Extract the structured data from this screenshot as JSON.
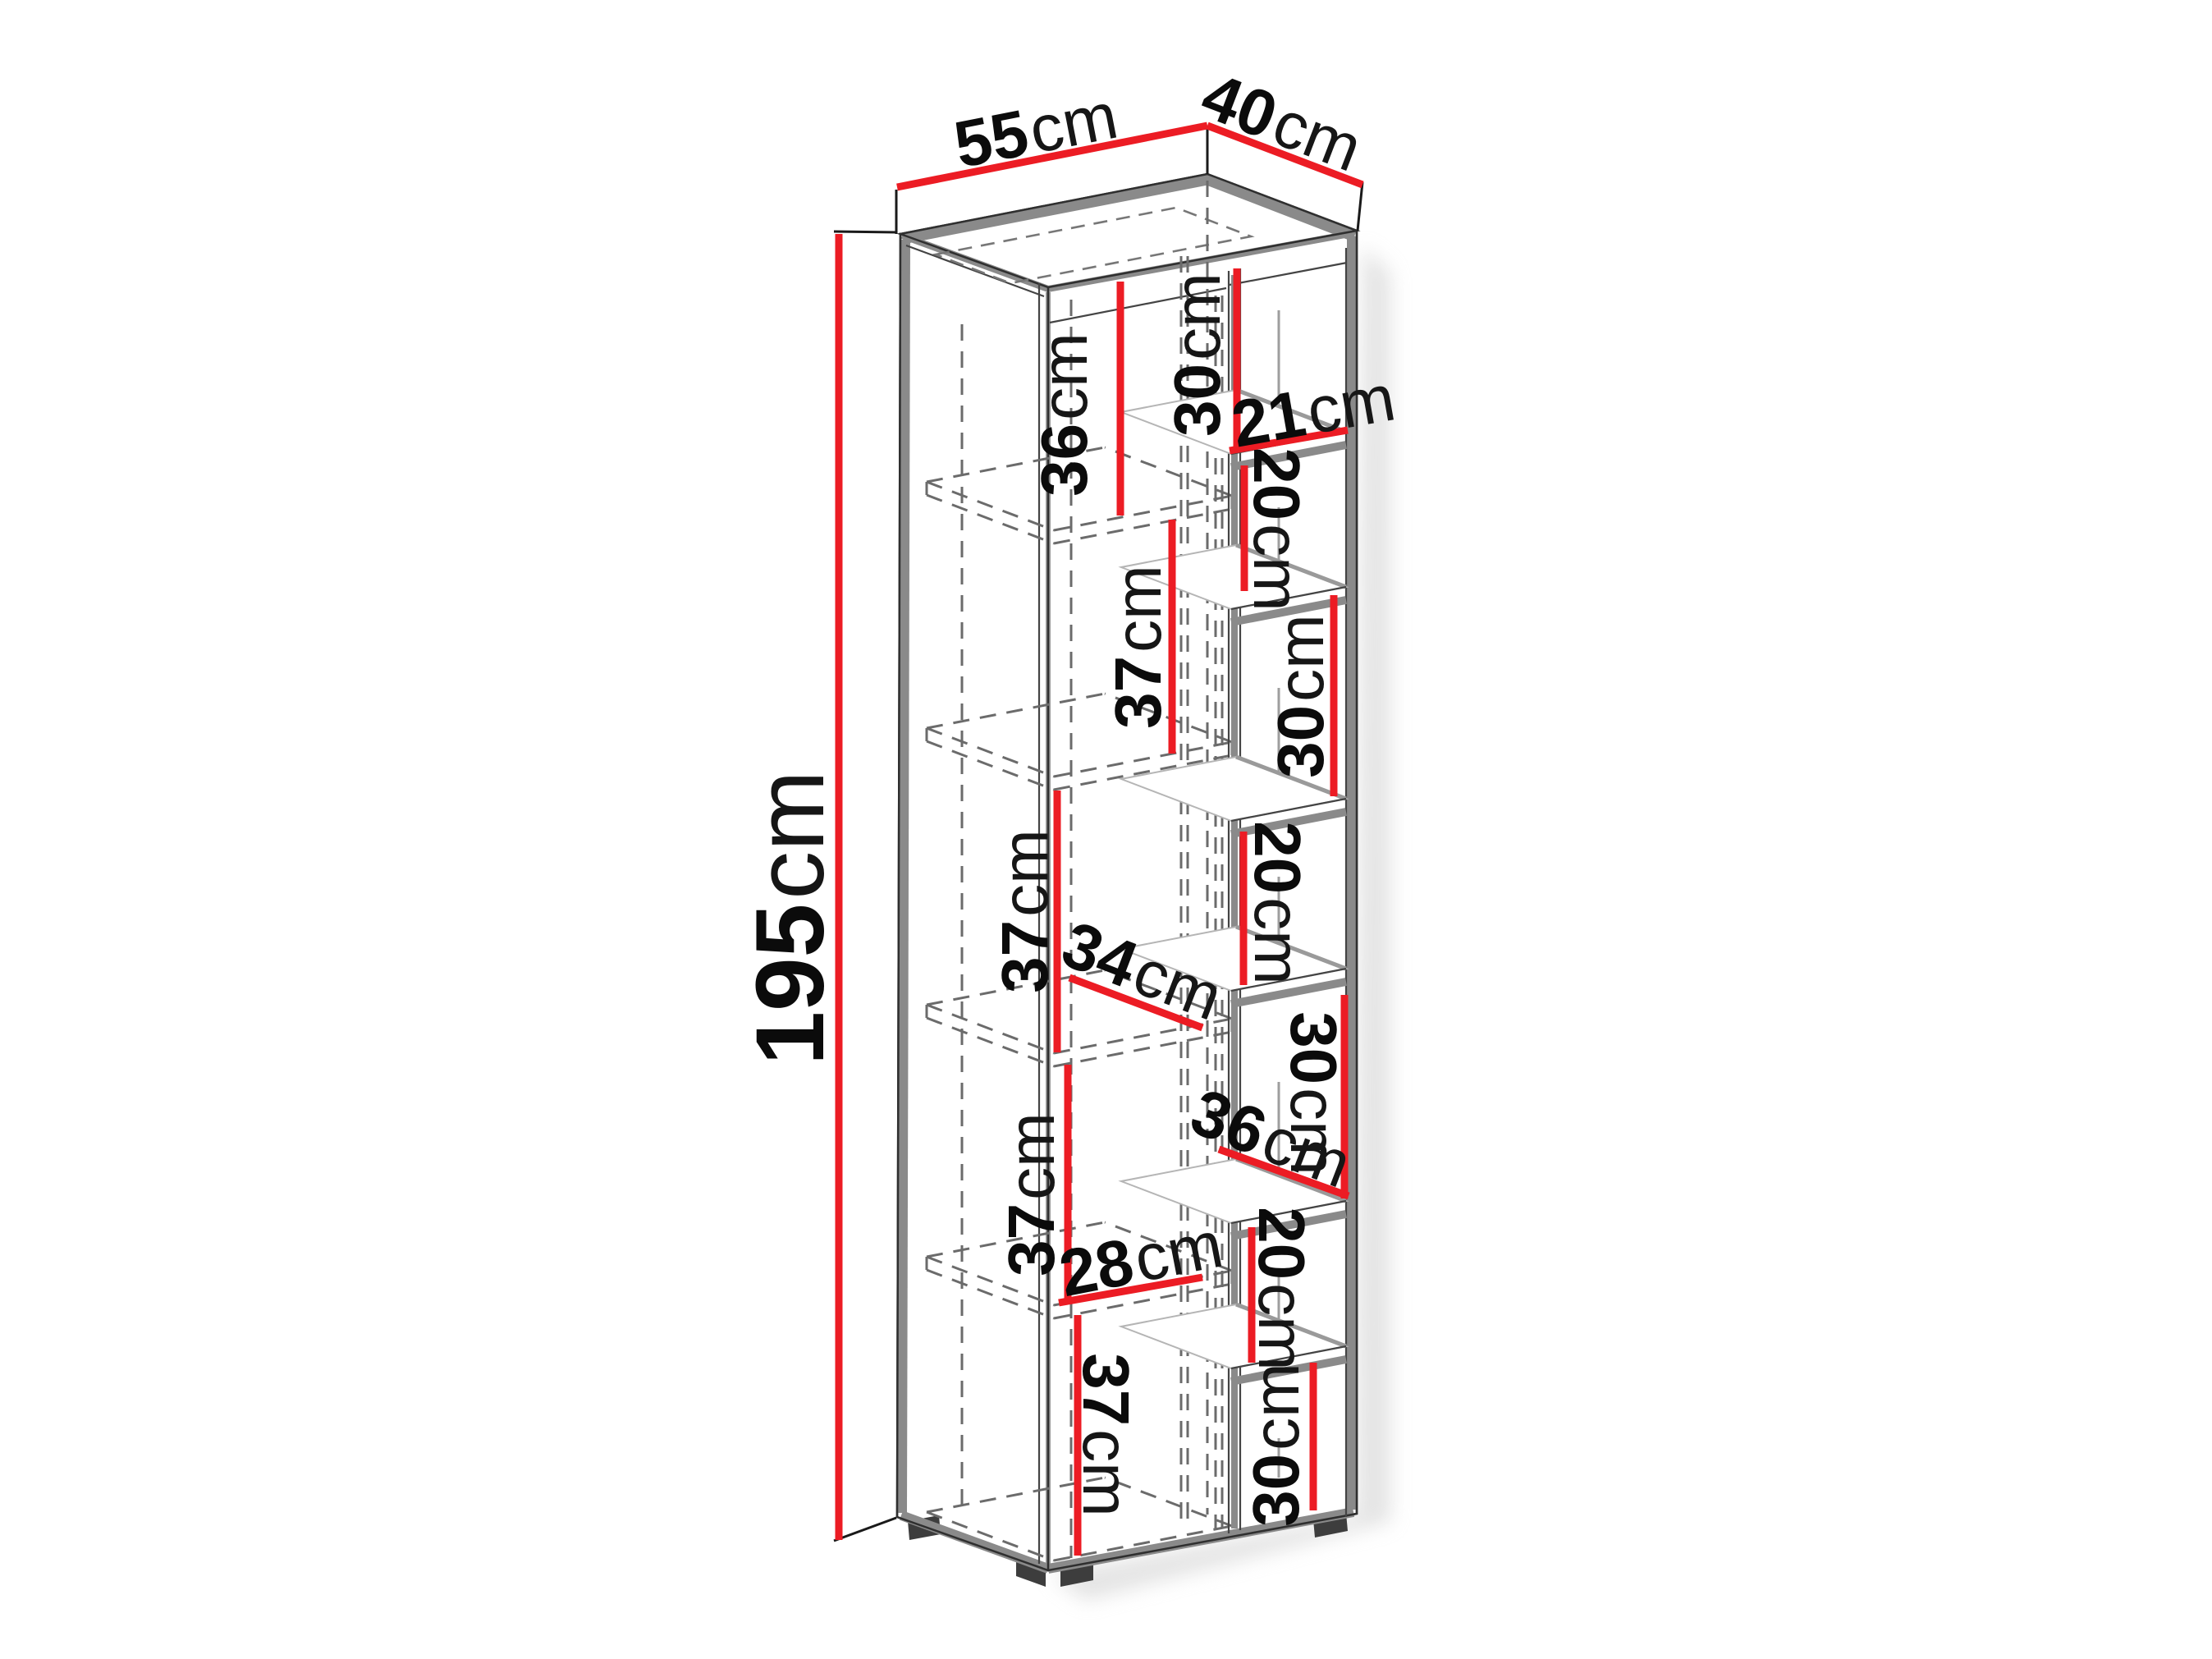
{
  "diagram": {
    "type": "furniture-dimension-drawing",
    "subject": "tall shelving cabinet isometric view with dimension lines",
    "unit": "cm",
    "colors": {
      "dimension_line": "#EC1C24",
      "edge_gray": "#8a8a8a",
      "outline": "#2f2f2f",
      "hidden_line": "#6b6b6b",
      "background": "#ffffff",
      "label_text": "#0b0b0b"
    },
    "overall": {
      "width_cm": "55",
      "depth_cm": "40",
      "height_cm": "195"
    },
    "left_column_compartment_heights_cm": [
      "36",
      "37",
      "37",
      "37",
      "37"
    ],
    "left_column_other_measures_cm": {
      "shelf_depth": "34",
      "interior_width": "28"
    },
    "right_column_compartment_heights_cm": [
      "30",
      "20",
      "30",
      "20",
      "30",
      "20",
      "30"
    ],
    "right_column_other_measures_cm": {
      "column_width": "21",
      "compartment_diagonal": "36"
    }
  },
  "dims": [
    {
      "value": "55",
      "unit": "cm"
    },
    {
      "value": "40",
      "unit": "cm"
    },
    {
      "value": "195",
      "unit": "cm"
    },
    {
      "value": "36",
      "unit": "cm"
    },
    {
      "value": "37",
      "unit": "cm"
    },
    {
      "value": "37",
      "unit": "cm"
    },
    {
      "value": "34",
      "unit": "cm"
    },
    {
      "value": "37",
      "unit": "cm"
    },
    {
      "value": "28",
      "unit": "cm"
    },
    {
      "value": "37",
      "unit": "cm"
    },
    {
      "value": "30",
      "unit": "cm"
    },
    {
      "value": "21",
      "unit": "cm"
    },
    {
      "value": "20",
      "unit": "cm"
    },
    {
      "value": "30",
      "unit": "cm"
    },
    {
      "value": "20",
      "unit": "cm"
    },
    {
      "value": "30",
      "unit": "cm"
    },
    {
      "value": "36",
      "unit": "cm"
    },
    {
      "value": "20",
      "unit": "cm"
    },
    {
      "value": "30",
      "unit": "cm"
    }
  ]
}
